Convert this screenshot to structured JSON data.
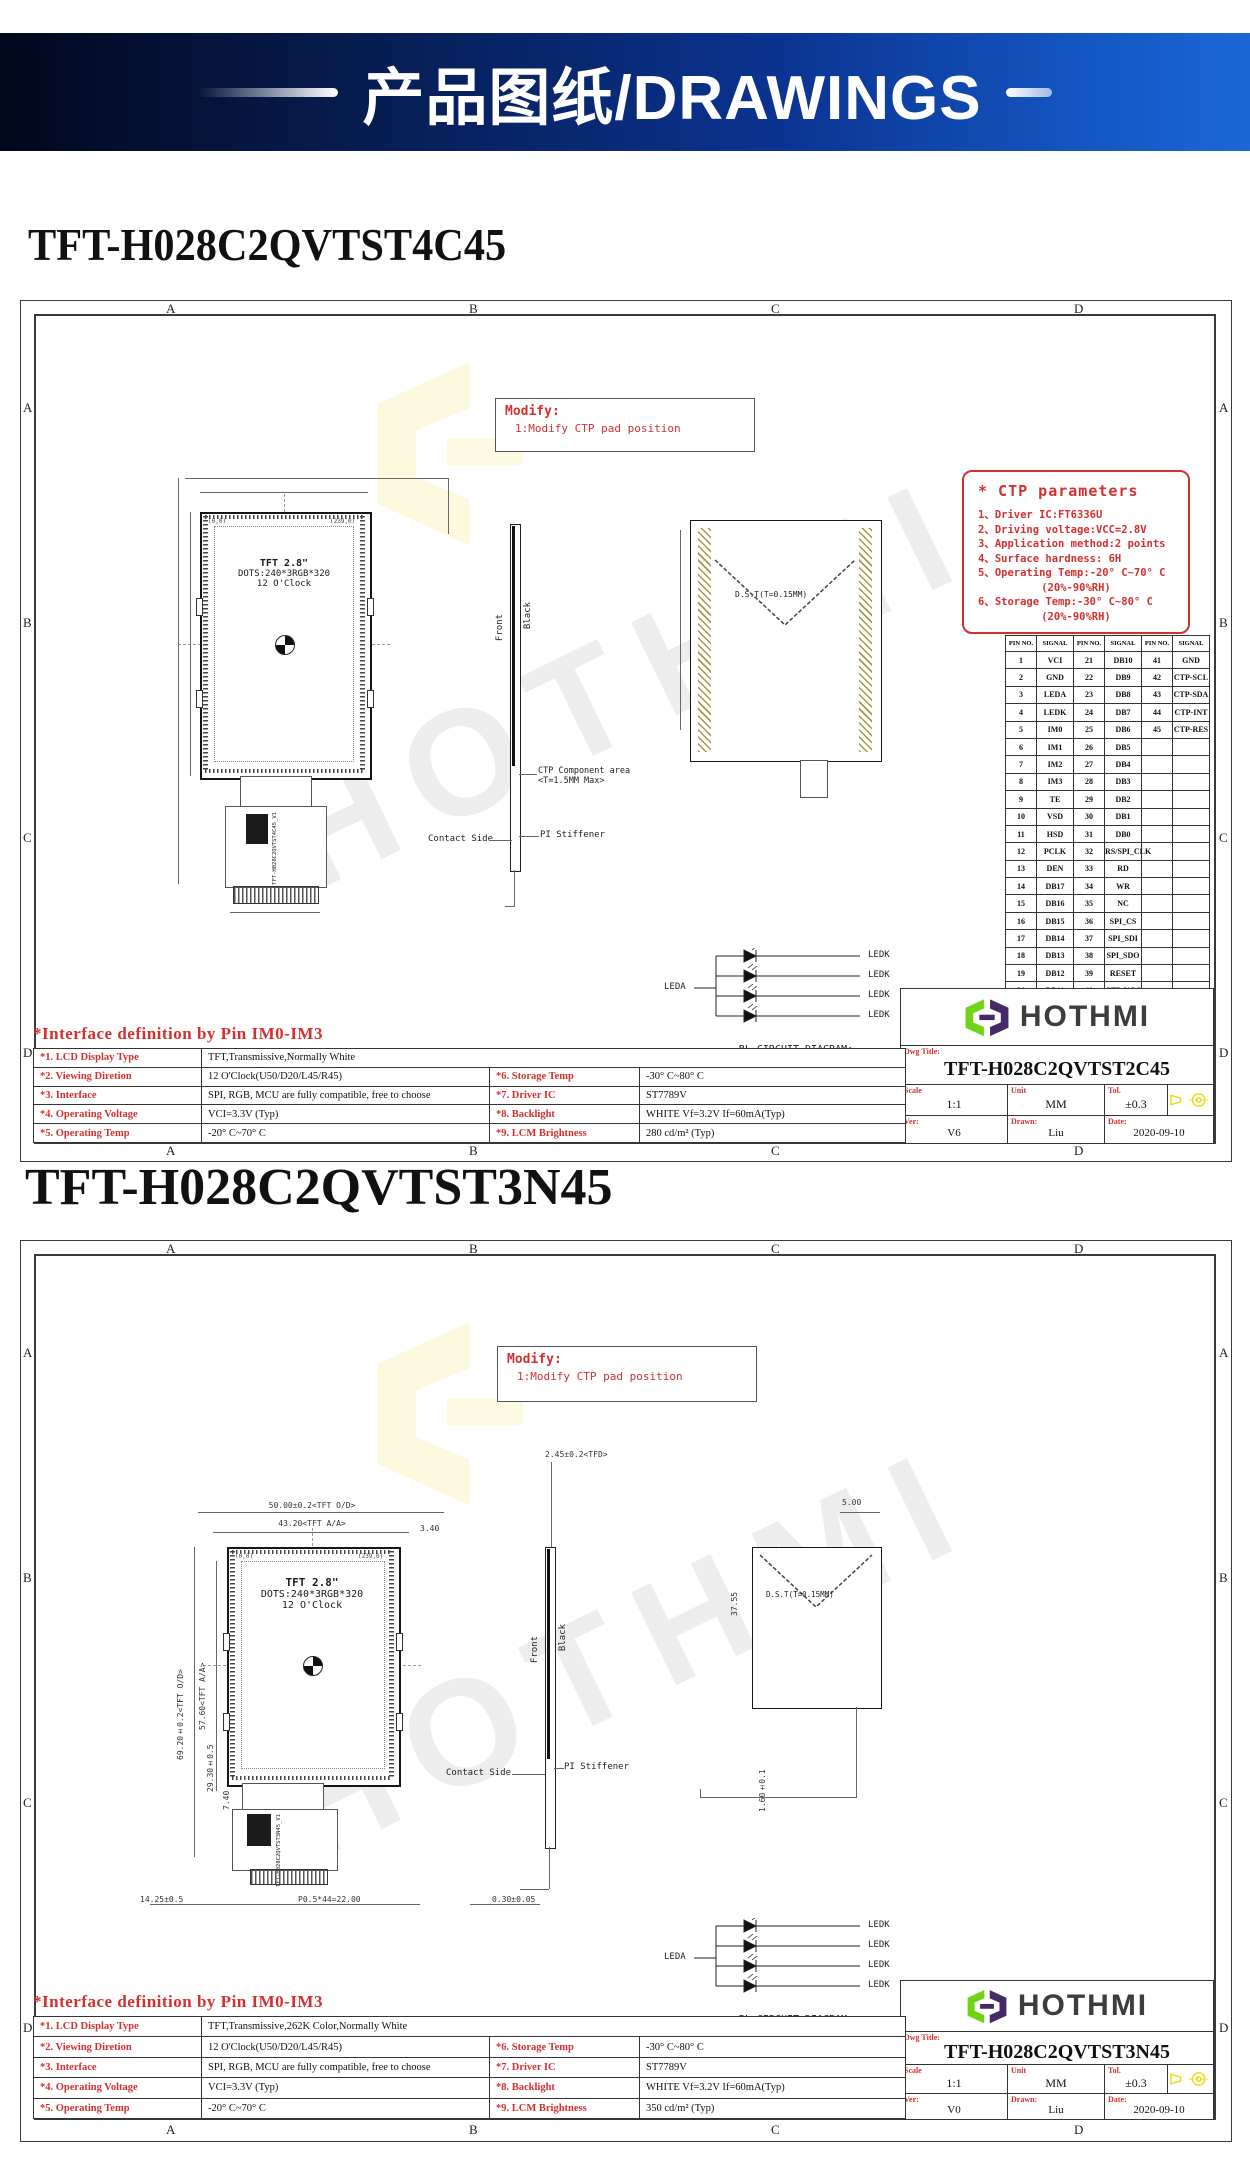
{
  "banner": {
    "text": "产品图纸/DRAWINGS"
  },
  "zones": [
    "A",
    "B",
    "C",
    "D"
  ],
  "colors": {
    "accent_red": "#d43030",
    "banner_blue": "#0b3390",
    "logo_green": "#6fd316",
    "logo_purple": "#462a68",
    "projection_yellow": "#ead800"
  },
  "drawings": [
    {
      "title": "TFT-H028C2QVTST4C45",
      "watermark": "HOTHMI",
      "modify": {
        "heading": "Modify:",
        "note": "1:Modify CTP pad position"
      },
      "panel": {
        "line1": "TFT 2.8\"",
        "line2": "DOTS:240*3RGB*320",
        "line3": "12 O'Clock",
        "corner_tl": "(0,0)",
        "corner_tr": "(239,0)",
        "fpc_label": "TFT-H028C2QVTST4C45_V1"
      },
      "side_view": {
        "front": "Front",
        "black": "Black",
        "ctp_note1": "CTP Component area",
        "ctp_note2": "<T=1.5MM Max>",
        "contact": "Contact Side",
        "stiffener": "PI Stiffener"
      },
      "right_view": {
        "dst": "D.S.T(T=0.15MM)"
      },
      "ctp_params": {
        "title": "* CTP parameters",
        "items": [
          "1、Driver IC:FT6336U",
          "2、Driving voltage:VCC=2.8V",
          "3、Application method:2 points",
          "4、Surface hardness: 6H",
          "5、Operating Temp:-20° C~70° C",
          "          (20%-90%RH)",
          "6、Storage Temp:-30° C~80° C",
          "          (20%-90%RH)"
        ]
      },
      "pin_table": {
        "headers": [
          "PIN NO.",
          "SIGNAL",
          "PIN NO.",
          "SIGNAL",
          "PIN NO.",
          "SIGNAL"
        ],
        "rows": [
          [
            "1",
            "VCI",
            "21",
            "DB10",
            "41",
            "GND"
          ],
          [
            "2",
            "GND",
            "22",
            "DB9",
            "42",
            "CTP-SCL"
          ],
          [
            "3",
            "LEDA",
            "23",
            "DB8",
            "43",
            "CTP-SDA"
          ],
          [
            "4",
            "LEDK",
            "24",
            "DB7",
            "44",
            "CTP-INT"
          ],
          [
            "5",
            "IM0",
            "25",
            "DB6",
            "45",
            "CTP-RES"
          ],
          [
            "6",
            "IM1",
            "26",
            "DB5",
            "",
            ""
          ],
          [
            "7",
            "IM2",
            "27",
            "DB4",
            "",
            ""
          ],
          [
            "8",
            "IM3",
            "28",
            "DB3",
            "",
            ""
          ],
          [
            "9",
            "TE",
            "29",
            "DB2",
            "",
            ""
          ],
          [
            "10",
            "VSD",
            "30",
            "DB1",
            "",
            ""
          ],
          [
            "11",
            "HSD",
            "31",
            "DB0",
            "",
            ""
          ],
          [
            "12",
            "PCLK",
            "32",
            "RS/SPI_CLK",
            "",
            ""
          ],
          [
            "13",
            "DEN",
            "33",
            "RD",
            "",
            ""
          ],
          [
            "14",
            "DB17",
            "34",
            "WR",
            "",
            ""
          ],
          [
            "15",
            "DB16",
            "35",
            "NC",
            "",
            ""
          ],
          [
            "16",
            "DB15",
            "36",
            "SPI_CS",
            "",
            ""
          ],
          [
            "17",
            "DB14",
            "37",
            "SPI_SDI",
            "",
            ""
          ],
          [
            "18",
            "DB13",
            "38",
            "SPI_SDO",
            "",
            ""
          ],
          [
            "19",
            "DB12",
            "39",
            "RESET",
            "",
            ""
          ],
          [
            "20",
            "DB11",
            "40",
            "CTP-VCC",
            "",
            ""
          ]
        ]
      },
      "bl_circuit": {
        "leda": "LEDA",
        "ledk": "LEDK",
        "caption1": "BL CIRCUIT DIAGRAM:",
        "caption2": "Vf=3.2V,If=60mA"
      },
      "title_block": {
        "brand": "HOTHMI",
        "dwg_title_label": "Dwg Title:",
        "dwg_title": "TFT-H028C2QVTST2C45",
        "scale_label": "Scale",
        "scale": "1:1",
        "unit_label": "Unit",
        "unit": "MM",
        "tol_label": "Tol.",
        "tol": "±0.3",
        "ver_label": "Ver:",
        "ver": "V6",
        "drawn_label": "Drawn:",
        "drawn": "Liu",
        "date_label": "Date:",
        "date": "2020-09-10"
      },
      "interface": {
        "title": "*Interface definition by Pin IM0-IM3",
        "row1": {
          "label": "*1. LCD Display Type",
          "value": "TFT,Transmissive,Normally White"
        },
        "rows": [
          {
            "label": "*2. Viewing Diretion",
            "value": "12 O'Clock(U50/D20/L45/R45)",
            "label2": "*6. Storage Temp",
            "value2": "-30° C~80° C"
          },
          {
            "label": "*3. Interface",
            "value": "SPI, RGB, MCU are fully compatible, free to choose",
            "label2": "*7. Driver IC",
            "value2": "ST7789V"
          },
          {
            "label": "*4. Operating Voltage",
            "value": "VCI=3.3V (Typ)",
            "label2": "*8. Backlight",
            "value2": "WHITE Vf=3.2V If=60mA(Typ)"
          },
          {
            "label": "*5. Operating Temp",
            "value": "-20° C~70° C",
            "label2": "*9. LCM Brightness",
            "value2": "280 cd/m² (Typ)"
          }
        ]
      }
    },
    {
      "title": "TFT-H028C2QVTST3N45",
      "watermark": "HOTHMI",
      "modify": {
        "heading": "Modify:",
        "note": "1:Modify CTP pad position"
      },
      "panel": {
        "line1": "TFT 2.8\"",
        "line2": "DOTS:240*3RGB*320",
        "line3": "12 O'Clock",
        "corner_tl": "(0,0)",
        "corner_tr": "(239,0)",
        "fpc_label": "TFT-H028C2QVTST3N45_V1"
      },
      "side_view": {
        "front": "Front",
        "black": "Black",
        "contact": "Contact Side",
        "stiffener": "PI Stiffener"
      },
      "right_view": {
        "dst": "D.S.T(T=0.15MM)"
      },
      "dims": {
        "od_w": "50.00±0.2<TFT O/D>",
        "aa_w": "43.20<TFT A/A>",
        "gap_right": "3.40",
        "od_h": "69.20±0.2<TFT O/D>",
        "aa_h": "57.60<TFT A/A>",
        "fpc_h": "29.30±0.5",
        "fpc_w2": "7.40",
        "conn_offset": "14.25±0.5",
        "pin_pitch": "P0.5*44=22.00",
        "fpc_t": "0.30±0.05",
        "tfd": "2.45±0.2<TFD>",
        "top_gap": "5.00",
        "va_h": "37.55",
        "tail": "1.60±0.1"
      },
      "bl_circuit": {
        "leda": "LEDA",
        "ledk": "LEDK",
        "caption1": "BL CIRCUIT DIAGRAM:",
        "caption2": "Vf=3.2V,If=60mA"
      },
      "title_block": {
        "brand": "HOTHMI",
        "dwg_title_label": "Dwg Title:",
        "dwg_title": "TFT-H028C2QVTST3N45",
        "scale_label": "Scale",
        "scale": "1:1",
        "unit_label": "Unit",
        "unit": "MM",
        "tol_label": "Tol.",
        "tol": "±0.3",
        "ver_label": "Ver:",
        "ver": "V0",
        "drawn_label": "Drawn:",
        "drawn": "Liu",
        "date_label": "Date:",
        "date": "2020-09-10"
      },
      "interface": {
        "title": "*Interface definition by Pin IM0-IM3",
        "row1": {
          "label": "*1. LCD Display Type",
          "value": "TFT,Transmissive,262K Color,Normally White"
        },
        "rows": [
          {
            "label": "*2. Viewing Diretion",
            "value": "12 O'Clock(U50/D20/L45/R45)",
            "label2": "*6. Storage Temp",
            "value2": "-30° C~80° C"
          },
          {
            "label": "*3. Interface",
            "value": "SPI, RGB, MCU are fully compatible, free to choose",
            "label2": "*7. Driver IC",
            "value2": "ST7789V"
          },
          {
            "label": "*4. Operating Voltage",
            "value": "VCI=3.3V (Typ)",
            "label2": "*8. Backlight",
            "value2": "WHITE Vf=3.2V If=60mA(Typ)"
          },
          {
            "label": "*5. Operating Temp",
            "value": "-20° C~70° C",
            "label2": "*9. LCM Brightness",
            "value2": "350 cd/m² (Typ)"
          }
        ]
      }
    }
  ]
}
